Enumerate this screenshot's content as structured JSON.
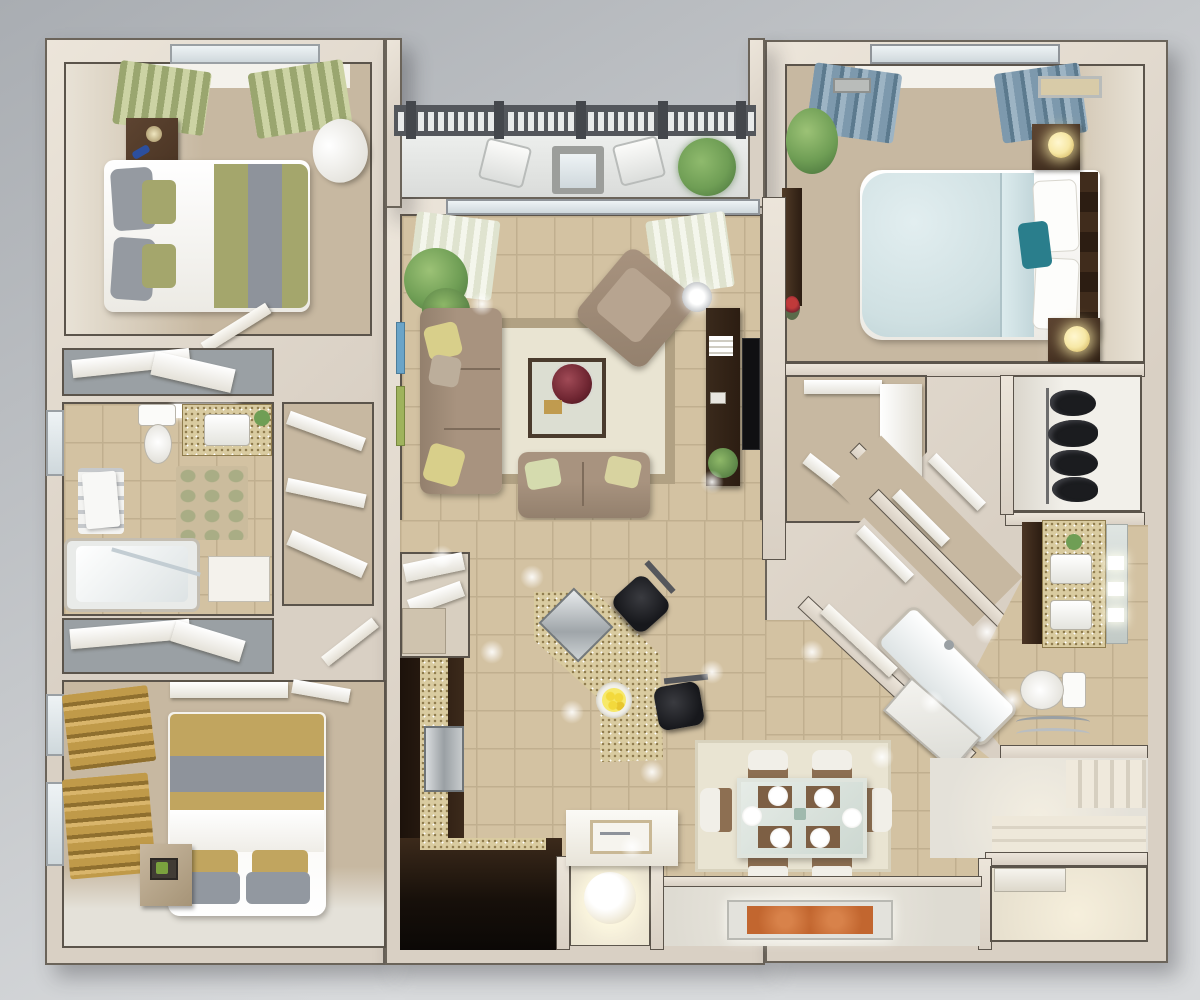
{
  "scene": {
    "title": "3D rendered top-down floor plan of a two-bedroom-plus-den apartment",
    "rooms": {
      "balcony": {
        "label": "Balcony with railing, two chairs, side table and potted tree"
      },
      "bedroom2": {
        "label": "Bedroom with olive and grey bed, nightstand, heart chair and green curtains"
      },
      "bathroom1": {
        "label": "Bathroom with toilet, vanity, pebble mat, towel rack and bathtub"
      },
      "closet_a": {
        "label": "Linen closet with shelves"
      },
      "closet_b": {
        "label": "Linen closet with shelves"
      },
      "tall_closet": {
        "label": "Reach-in closet with angled shelves"
      },
      "bedroom3": {
        "label": "Bedroom with khaki and grey bed, wooden blinds and shelf"
      },
      "living": {
        "label": "Living room with sectional sofa, loveseat, armchair, glass coffee table, TV wall and plants"
      },
      "kitchen": {
        "label": "Kitchen with dark cabinets, granite island, cooktop and two bar stools"
      },
      "pantry": {
        "label": "Pantry closet"
      },
      "dining": {
        "label": "Dining area with glass table, six chairs and six place settings"
      },
      "master": {
        "label": "Master bedroom with light blue bed, teal pillow, nightstands with lamps and blue curtains"
      },
      "walkin": {
        "label": "Walk-in closet with white shelving"
      },
      "clothes": {
        "label": "Closet with dark garments hanging on a rod"
      },
      "bath2": {
        "label": "Master bathroom with double granite vanity, mirror lights, toilet, towel rack and diagonal bathtub"
      },
      "hall": {
        "label": "Diagonal hallway with linen shelves"
      },
      "entry": {
        "label": "Entry hall with orange rug, console table and sphere lamp nook"
      },
      "foyer": {
        "label": "Foyer with paneled closet doors"
      },
      "storage": {
        "label": "Storage room with white cabinets"
      }
    },
    "counts": {
      "dining_plates": 6,
      "dining_chairs": 6,
      "bar_stools": 2,
      "balcony_chairs": 2,
      "hanging_garments": 4,
      "railing_posts": 5,
      "wall_art_frames": 2,
      "bedroom3_windows": 2
    }
  },
  "palette": {
    "bg_top": "#a9adb2",
    "bg_bottom": "#d8dadc",
    "wall": "#d9d0c4",
    "wall_hi": "#ece5da",
    "wall_line": "#5b544b",
    "carpet": "#c7b8a1",
    "carpet_light": "#e8e2d6",
    "tile": "#d3c2a2",
    "tile_line": "#c0af8f",
    "rug": "#e9e4d2",
    "rug_border": "#b1a183",
    "wood": "#2c1d12",
    "wood_mid": "#4b3524",
    "granite": "#d9cba0",
    "granite_dot": "#8f7c4e",
    "sofa": "#a8937f",
    "sofa_dark": "#93806d",
    "olive": "#a4a66c",
    "khaki": "#c1a55f",
    "textile_gray": "#8e939b",
    "duvet_blue": "#cfe0e2",
    "teal": "#2a7e8c",
    "curtain_green": "#9aa66f",
    "curtain_blue": "#7d99ad",
    "curtain_gold": "#c09a49",
    "plant": "#6f9e55",
    "plant_dark": "#46703a",
    "black": "#17181c",
    "white_floor": "#e4e1d9",
    "closet_floor": "#9aa0a4",
    "red_bowl": "#6e2531",
    "rug_orange": "#c2662f",
    "lamp_glow": "#f7e8a6",
    "steel": "#b9bec2"
  }
}
